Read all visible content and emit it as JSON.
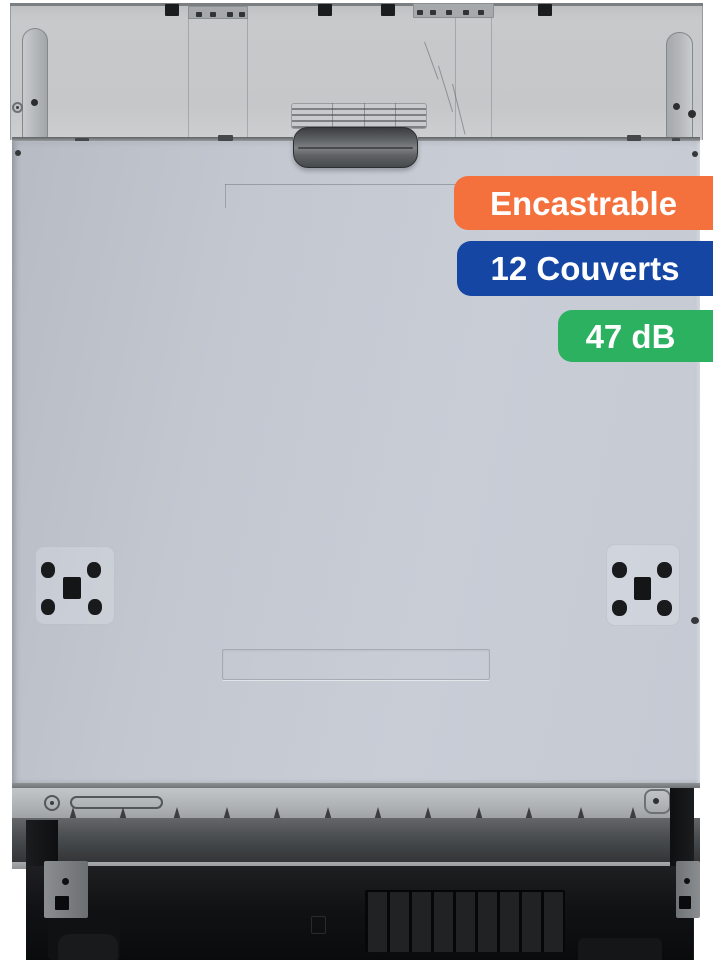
{
  "badges": [
    {
      "label": "Encastrable",
      "background": "#F4703C",
      "text_color": "#FFFFFF"
    },
    {
      "label": "12 Couverts",
      "background": "#1546A3",
      "text_color": "#FFFFFF"
    },
    {
      "label": "47 dB",
      "background": "#2BB15F",
      "text_color": "#FFFFFF"
    }
  ],
  "colors": {
    "page_background": "#FFFFFF",
    "top_panel": "#C6C8CA",
    "door_panel": "#C5CAD3",
    "handle": "#4A4D4F",
    "kick_strip": "#B1B4B6",
    "base_black": "#111214"
  }
}
